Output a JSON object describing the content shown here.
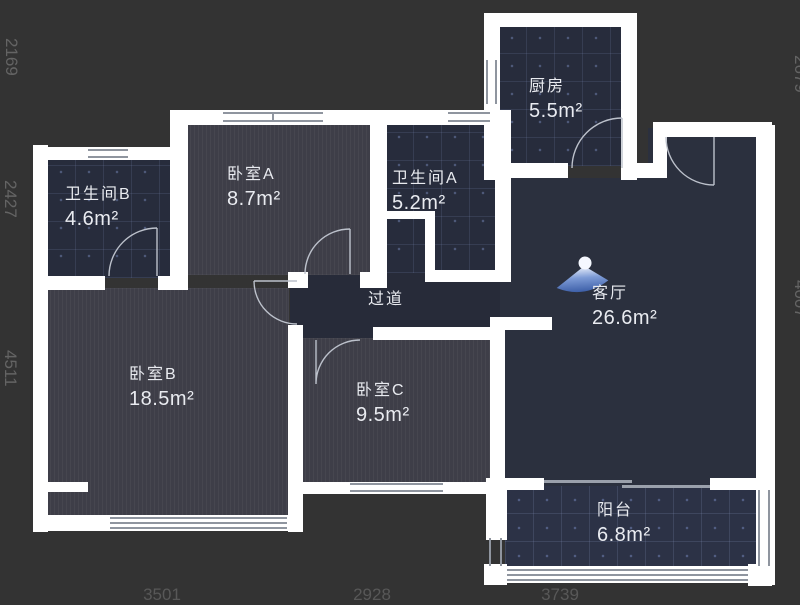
{
  "plan": {
    "type": "apartment-floor-plan",
    "theme": "dark",
    "colors": {
      "background": "#333333",
      "wall": "#ffffff",
      "tile_room_fill": "#272c3c",
      "wood_room_fill": "#3e3e48",
      "living_fill": "#2b303e",
      "balcony_fill": "#2c3246",
      "label_text": "#e9ebf0",
      "dimension_text": "#646464",
      "panorama_blue": "#4a6cb3"
    }
  },
  "rooms": [
    {
      "id": "kitchen",
      "name": "厨房",
      "area": "5.5m²"
    },
    {
      "id": "bathroomB",
      "name": "卫生间B",
      "area": "4.6m²"
    },
    {
      "id": "bedroomA",
      "name": "卧室A",
      "area": "8.7m²"
    },
    {
      "id": "bathroomA",
      "name": "卫生间A",
      "area": "5.2m²"
    },
    {
      "id": "living",
      "name": "客厅",
      "area": "26.6m²"
    },
    {
      "id": "hallway",
      "name": "过道",
      "area": ""
    },
    {
      "id": "bedroomB",
      "name": "卧室B",
      "area": "18.5m²"
    },
    {
      "id": "bedroomC",
      "name": "卧室C",
      "area": "9.5m²"
    },
    {
      "id": "balcony",
      "name": "阳台",
      "area": "6.8m²"
    }
  ],
  "dimensions": {
    "left": [
      "2169",
      "2427",
      "4511"
    ],
    "bottom": [
      "3501",
      "2928",
      "3739"
    ],
    "right": [
      "2679",
      "4007"
    ]
  },
  "icons": {
    "panorama": "panorama-view-cone-icon"
  }
}
